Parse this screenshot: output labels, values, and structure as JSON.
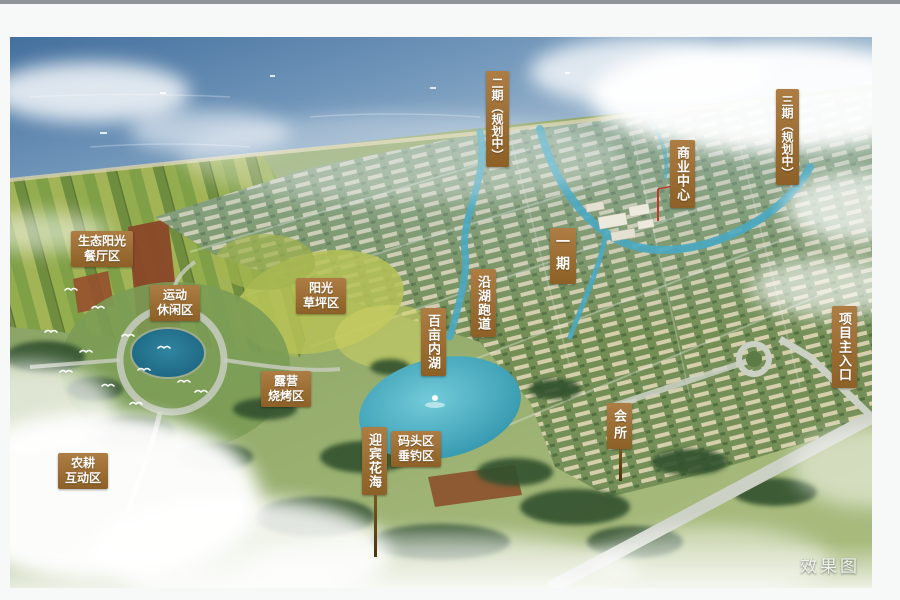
{
  "page": {
    "top_bar_color": "#8e959b",
    "background": "#f7f8f8",
    "watermark": "效果图"
  },
  "scene": {
    "type": "aerial-masterplan-rendering",
    "colors": {
      "sea": "#44709e",
      "sea_light": "#b7cbd9",
      "land": "#7e9a5e",
      "lake": "#2f93ab",
      "river": "#4aa9c2",
      "road": "#c9cfc0",
      "field_red": "#8a4728",
      "label_bg": "#9c6c31",
      "label_text": "#ffffff"
    }
  },
  "map": {
    "labels": [
      {
        "id": "eco-sunshine-restaurant-zone",
        "lines": [
          "生态阳光",
          "餐厅区"
        ],
        "orientation": "horizontal",
        "x": 71,
        "y": 231
      },
      {
        "id": "sports-leisure-zone",
        "lines": [
          "运动",
          "休闲区"
        ],
        "orientation": "horizontal",
        "x": 150,
        "y": 285
      },
      {
        "id": "sunshine-lawn-zone",
        "lines": [
          "阳光",
          "草坪区"
        ],
        "orientation": "horizontal",
        "x": 296,
        "y": 278
      },
      {
        "id": "camping-bbq-zone",
        "lines": [
          "露营",
          "烧烤区"
        ],
        "orientation": "horizontal",
        "x": 261,
        "y": 371
      },
      {
        "id": "farming-interactive-zone",
        "lines": [
          "农耕",
          "互动区"
        ],
        "orientation": "horizontal",
        "x": 58,
        "y": 453
      },
      {
        "id": "dock-fishing-zone",
        "lines": [
          "码头区",
          "垂钓区"
        ],
        "orientation": "horizontal",
        "x": 391,
        "y": 431
      },
      {
        "id": "welcome-flower-sea",
        "text": "迎宾花海",
        "orientation": "vertical",
        "x": 362,
        "y": 427,
        "pole": 62
      },
      {
        "id": "hundred-acre-inner-lake",
        "text": "百亩内湖",
        "orientation": "vertical",
        "x": 421,
        "y": 308
      },
      {
        "id": "lakeside-running-track",
        "text": "沿湖跑道",
        "orientation": "vertical",
        "x": 471,
        "y": 269
      },
      {
        "id": "phase-1",
        "text": "一期",
        "orientation": "vertical",
        "x": 550,
        "y": 228,
        "font": 14,
        "ls": 8
      },
      {
        "id": "phase-2-planning",
        "text": "二期（规划中）",
        "orientation": "vertical",
        "x": 486,
        "y": 71,
        "font": 12,
        "ls": 0
      },
      {
        "id": "phase-3-planning",
        "text": "三期（规划中）",
        "orientation": "vertical",
        "x": 776,
        "y": 89,
        "font": 12,
        "ls": 0
      },
      {
        "id": "commercial-center",
        "text": "商业中心",
        "orientation": "vertical",
        "x": 670,
        "y": 140
      },
      {
        "id": "clubhouse",
        "text": "会所",
        "orientation": "vertical",
        "x": 607,
        "y": 403,
        "ls": 4,
        "pole": 32
      },
      {
        "id": "main-entrance",
        "text": "项目主入口",
        "orientation": "vertical",
        "x": 832,
        "y": 306
      }
    ]
  }
}
